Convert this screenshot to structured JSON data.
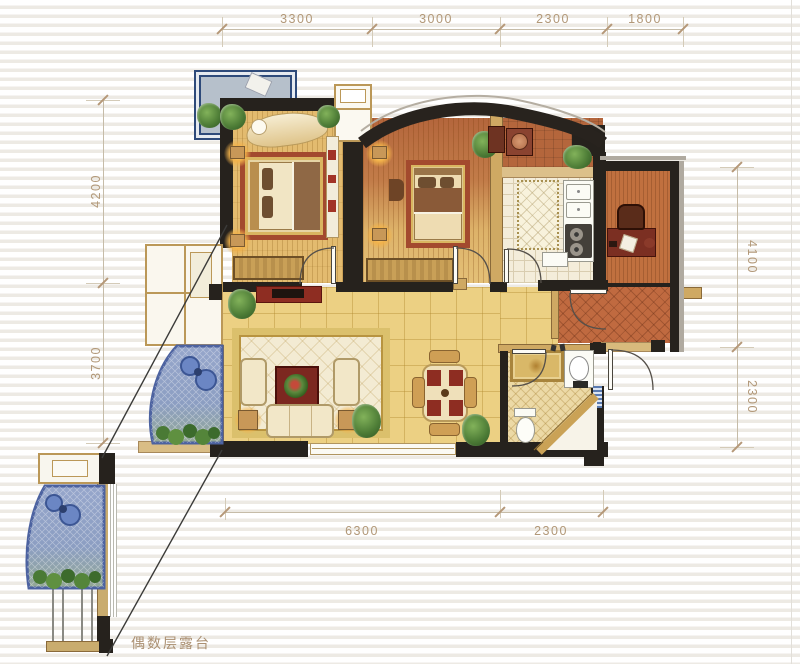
{
  "title": "apartment-floor-plan",
  "dimensions": {
    "top": [
      "3300",
      "3000",
      "2300",
      "1800"
    ],
    "left": [
      "4200",
      "3700"
    ],
    "right": [
      "4100",
      "2300"
    ],
    "bottom": [
      "6300",
      "2300"
    ]
  },
  "labels": {
    "terrace_note": "偶数层露台"
  },
  "rooms": [
    "terrace",
    "master-bedroom",
    "bedroom-2",
    "utility",
    "kitchen",
    "study",
    "living-dining-room",
    "bathroom",
    "balcony",
    "entry-hall"
  ],
  "colors": {
    "dimension_text": "#b29878",
    "wall": "#26221d",
    "bedroom_floor": "#e3bb6f",
    "living_floor": "#ecd083",
    "kitchen_floor": "#f4edda",
    "study_floor": "#c0703f",
    "bath_floor": "#ecd9a6",
    "balcony_glass": "#96a6cb",
    "terrace_floor": "#b6c0cb",
    "accent_red": "#8e2d22"
  }
}
